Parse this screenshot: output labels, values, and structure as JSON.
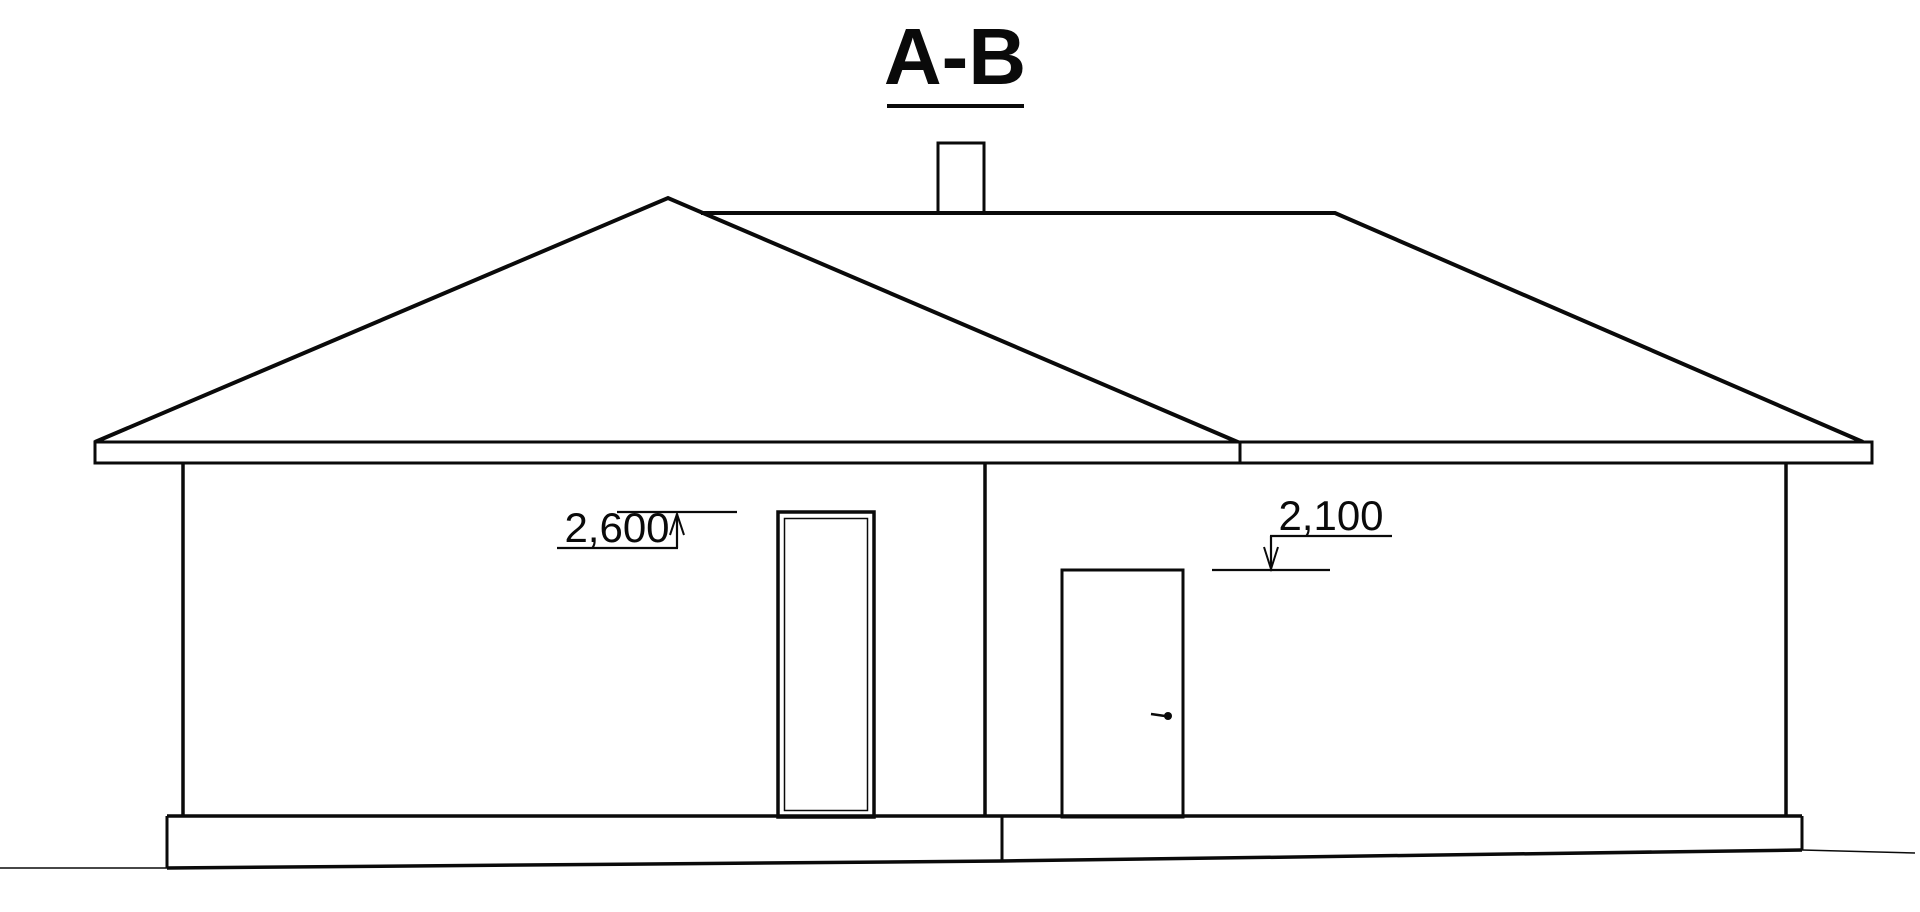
{
  "page": {
    "background_color": "#ffffff",
    "line_color": "#0a0a0a"
  },
  "drawing": {
    "title": "A-B",
    "annotations": {
      "window_head_level": "2,600",
      "door_head_level": "2,100"
    }
  }
}
